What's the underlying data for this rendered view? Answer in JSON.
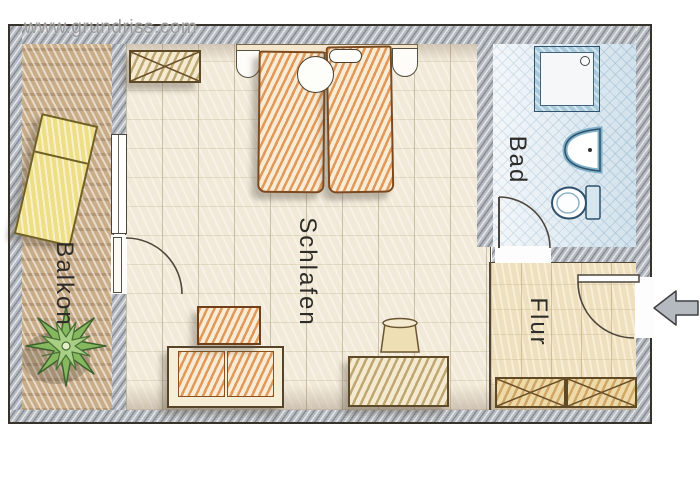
{
  "watermark": "www.grundriss.com",
  "rooms": {
    "balcony": {
      "label": "Balkon",
      "items": [
        "sun-lounger",
        "potted-plant"
      ]
    },
    "bedroom": {
      "label": "Schlafen",
      "items": [
        "wardrobe",
        "double-bed",
        "sofa",
        "coffee-table",
        "desk",
        "stool"
      ]
    },
    "bathroom": {
      "label": "Bad",
      "items": [
        "shower",
        "washbasin",
        "toilet"
      ]
    },
    "hallway": {
      "label": "Flur",
      "items": [
        "wardrobe",
        "entrance-door"
      ]
    }
  },
  "colors": {
    "wall_gray": "#b6bbc1",
    "bedroom_floor": "#f2ead9",
    "balcony_floor": "#c9ac88",
    "bathroom_floor": "#e6eef4",
    "hallway_floor": "#eee0bf",
    "furniture_orange": "#de8a42",
    "furniture_tan": "#b2965c",
    "lounger_yellow": "#eede85",
    "plant_green": "#86b860",
    "fixture_blue": "#7fb0c8",
    "outline_dark": "#38332a"
  }
}
